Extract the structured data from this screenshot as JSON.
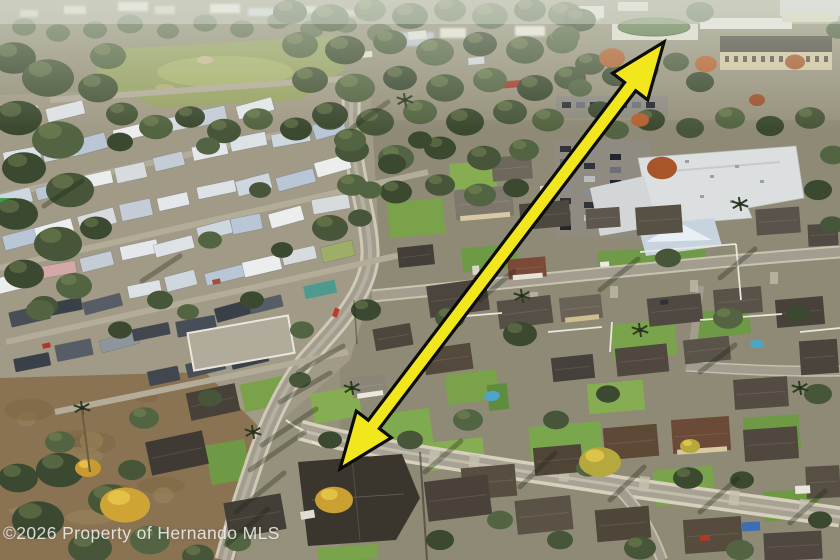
{
  "watermark": {
    "text": "©2026 Property of Hernando MLS",
    "color": "rgba(244,244,242,0.85)"
  },
  "annotation_arrow": {
    "fill": "#f2e71c",
    "outline": "#0c0c0c",
    "tail_x": 340,
    "tail_y": 469,
    "head_x": 664,
    "head_y": 42,
    "head_length": 56,
    "head_half_width": 22,
    "shaft_half_width": 7
  }
}
